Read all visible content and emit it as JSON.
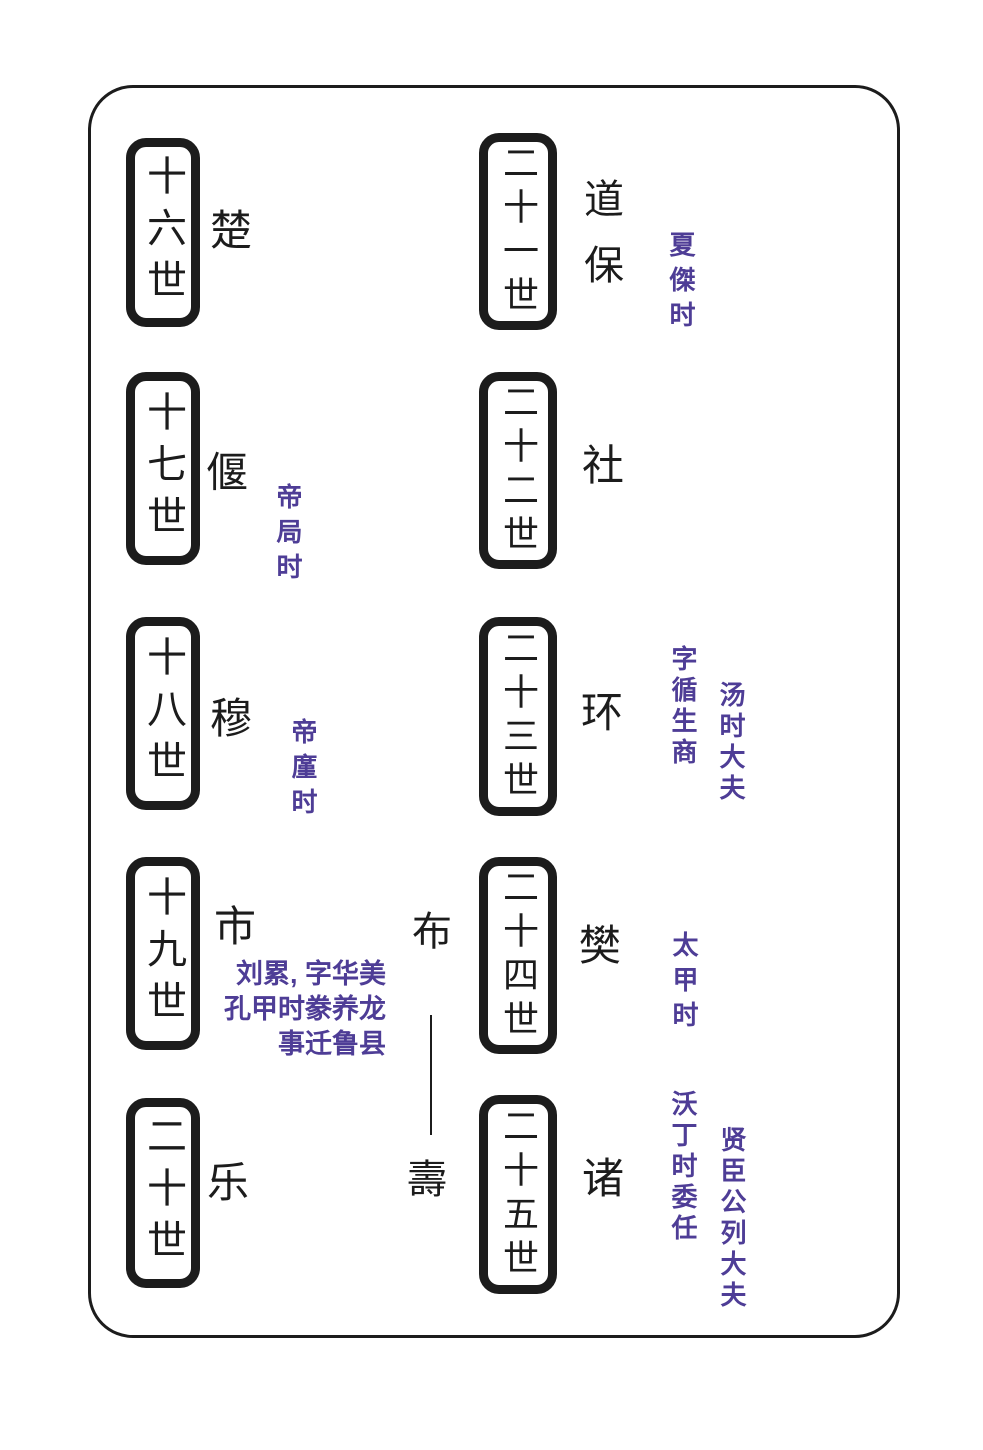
{
  "diagram_type": "genealogy-lineage-chart",
  "colors": {
    "ink": "#1c1c1c",
    "annotation_purple": "#4e3d96",
    "background": "#ffffff"
  },
  "left_column": [
    {
      "generation": "十六世",
      "name": "楚"
    },
    {
      "generation": "十七世",
      "name": "偃",
      "note": "帝局时"
    },
    {
      "generation": "十八世",
      "name": "穆",
      "note": "帝廑时"
    },
    {
      "generation": "十九世",
      "name": "市",
      "note_lines": [
        "刘累, 字华美",
        "孔甲时豢养龙",
        "事迁鲁县"
      ]
    },
    {
      "generation": "二十世",
      "name": "乐"
    }
  ],
  "connector": {
    "top_name": "布",
    "bottom_name": "壽"
  },
  "right_column": [
    {
      "generation": "二十一世",
      "name": "道保",
      "note": "夏傑时"
    },
    {
      "generation": "二十二世",
      "name": "社"
    },
    {
      "generation": "二十三世",
      "name": "环",
      "note": "字循生商",
      "note2": "汤时大夫"
    },
    {
      "generation": "二十四世",
      "name": "樊",
      "note": "太甲时"
    },
    {
      "generation": "二十五世",
      "name": "诸",
      "note": "沃丁时委任",
      "note2": "贤臣公列大夫"
    }
  ]
}
